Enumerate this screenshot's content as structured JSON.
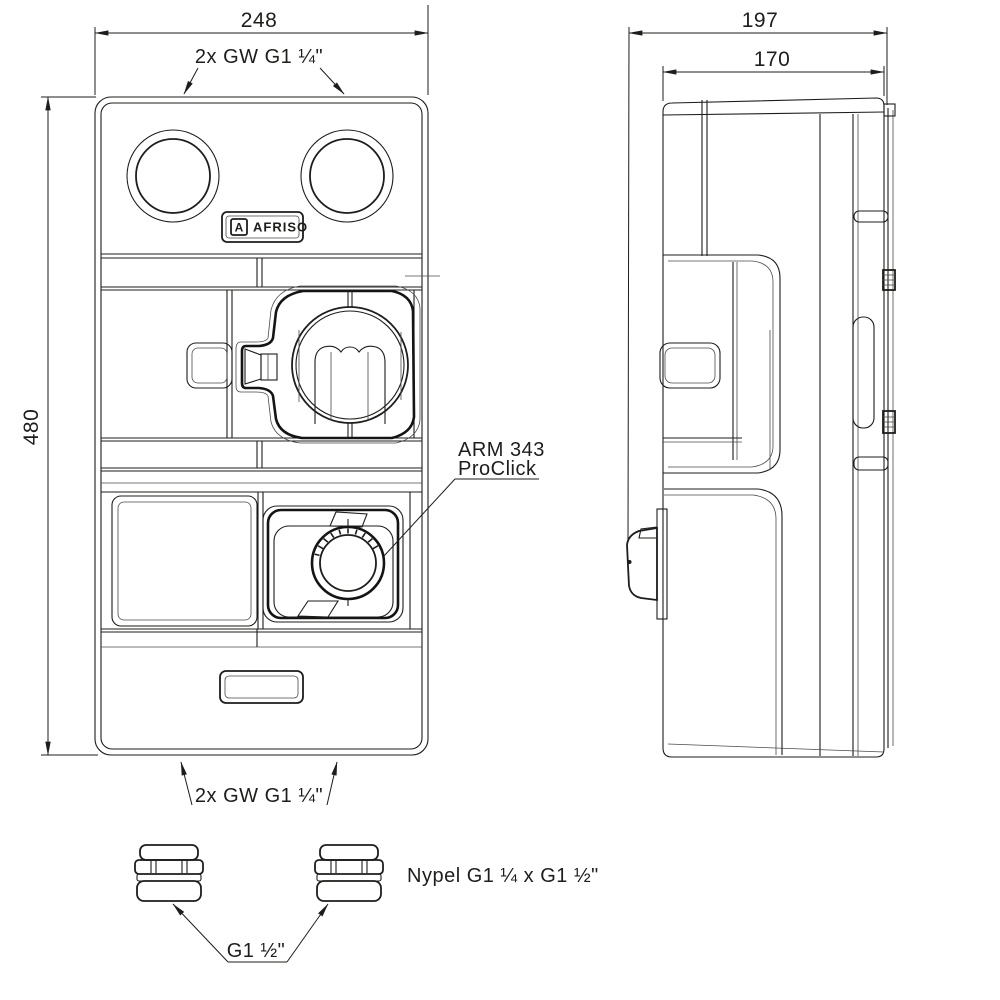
{
  "colors": {
    "line": "#1d1d1b",
    "background": "#ffffff"
  },
  "front_view": {
    "width_dim": "248",
    "height_dim": "480",
    "top_ports_label": "2x GW G1 ¼\"",
    "bottom_ports_label": "2x GW G1 ¼\"",
    "brand_monogram": "A",
    "brand_name": "AFRISO",
    "actuator_label_line1": "ARM 343",
    "actuator_label_line2": "ProClick"
  },
  "side_view": {
    "overall_depth_dim": "197",
    "body_depth_dim": "170"
  },
  "fittings": {
    "nipple_label": "Nypel G1 ¼ x G1 ½\"",
    "thread_label": "G1 ½\""
  }
}
